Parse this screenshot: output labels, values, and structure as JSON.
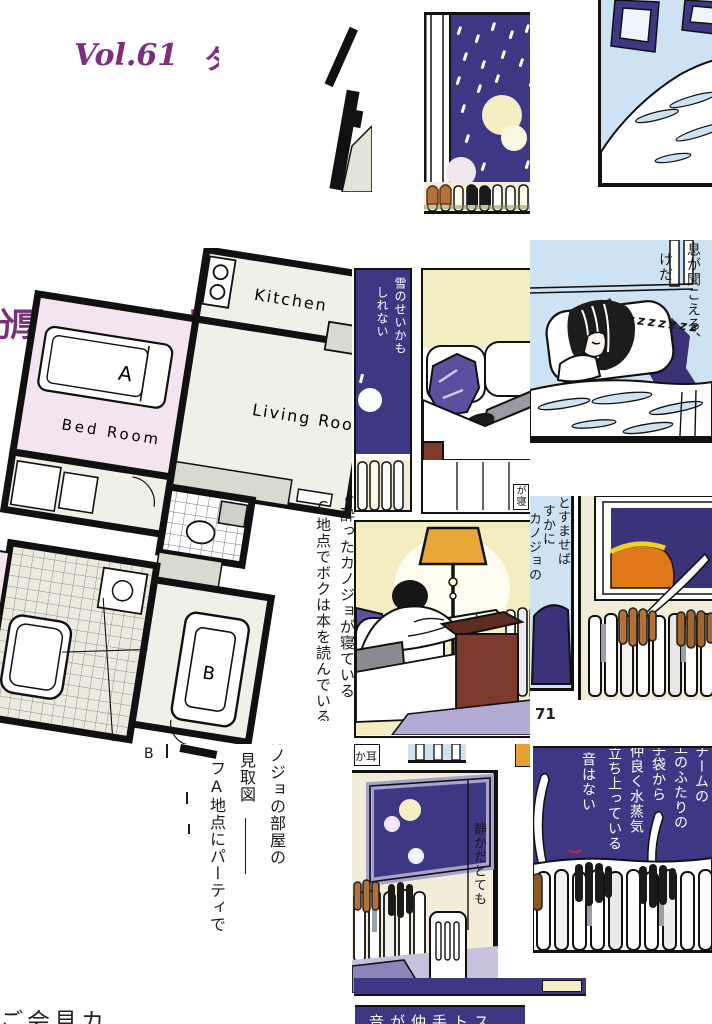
{
  "palette": {
    "paper": "#ffffff",
    "ink": "#1a1a1a",
    "title_purple": "#7b2f7e",
    "indigo": "#3e3884",
    "light_blue": "#cde3f3",
    "cream": "#f2ecd8",
    "wall_yellow": "#f4edc2",
    "room_pink": "#f4e4ef",
    "plan_floor": "#f1f0e8",
    "plan_gray": "#d9d9d0",
    "pillow_purple": "#5b4fa0",
    "rug_purple": "#8e84ba",
    "maroon": "#7c3a2c",
    "lamp_orange": "#e8a838",
    "painting_orange": "#e07818",
    "glove_brown": "#b5713a",
    "frame_lavender": "#a8a2cc",
    "moon_yellow": "#f4eec2",
    "moon_pink": "#f1e6ef"
  },
  "header": {
    "volume": "Vol.61",
    "volume_title_fragment": "タ"
  },
  "titles": {
    "left_fragment_1": "分厚い本を読むカ",
    "left_fragment_2": "ンキョウ"
  },
  "floor_plan": {
    "kitchen": "Kitchen",
    "living_room": "Living Room",
    "bed_room": "Bed Room",
    "bed_label": "A",
    "couch_label": "B",
    "fragment_label": "B"
  },
  "plan_notes": {
    "note_b": "で酔ったカノジョが寝ている",
    "note_c": "C地点でボクは本を読んでいる"
  },
  "legend": {
    "col1": "カノジョの部屋の",
    "col2": "見取図",
    "col3": "フA地点にパーティで"
  },
  "captions": {
    "snow_panel": [
      "雪のせいかも",
      "しれない"
    ],
    "sleep_panel": [
      "息が聞こえる、",
      "けだ"
    ],
    "sleep_zzz": "zzzzzzzz",
    "listen_panel": [
      "とすませば",
      "すかに",
      "カノジョの"
    ],
    "quiet_panel": "静かだとても",
    "steam_panel": [
      "チームの",
      "上のふたりの",
      "手袋から",
      "仲良く水蒸気",
      "立ち上っている",
      "音はない"
    ],
    "bottom_strip": "音が仲手トス",
    "fragment_top": "か耳",
    "fragment_sleep": "が寝",
    "bottom_left": "ご会見カ"
  },
  "page_number": "71"
}
